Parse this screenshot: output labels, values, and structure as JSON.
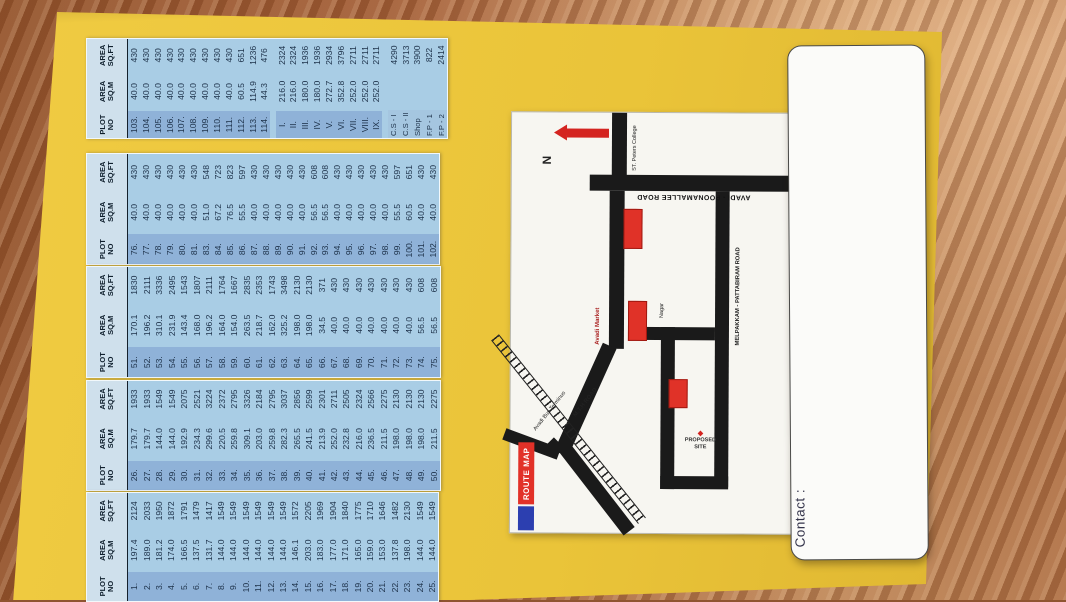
{
  "table_headers": [
    [
      "PLOT",
      "NO"
    ],
    [
      "AREA",
      "SQ.M"
    ],
    [
      "AREA",
      "SQ.FT"
    ]
  ],
  "tables": [
    {
      "name": "plots-103-114-and-blocks",
      "rows": [
        [
          "103.",
          "40.0",
          "430"
        ],
        [
          "104.",
          "40.0",
          "430"
        ],
        [
          "105.",
          "40.0",
          "430"
        ],
        [
          "106.",
          "40.0",
          "430"
        ],
        [
          "107.",
          "40.0",
          "430"
        ],
        [
          "108.",
          "40.0",
          "430"
        ],
        [
          "109.",
          "40.0",
          "430"
        ],
        [
          "110.",
          "40.0",
          "430"
        ],
        [
          "111.",
          "40.0",
          "430"
        ],
        [
          "112.",
          "60.5",
          "651"
        ],
        [
          "113.",
          "114.9",
          "1236"
        ],
        [
          "114.",
          "44.3",
          "476"
        ],
        null,
        [
          "I.",
          "216.0",
          "2324"
        ],
        [
          "II.",
          "216.0",
          "2324"
        ],
        [
          "III.",
          "180.0",
          "1936"
        ],
        [
          "IV.",
          "180.0",
          "1936"
        ],
        [
          "V.",
          "272.7",
          "2934"
        ],
        [
          "VI.",
          "352.8",
          "3796"
        ],
        [
          "VII.",
          "252.0",
          "2711"
        ],
        [
          "VIII.",
          "252.0",
          "2711"
        ],
        [
          "IX.",
          "252.0",
          "2711"
        ],
        null,
        [
          "C.S - I",
          "",
          "4290"
        ],
        [
          "C.S - II",
          "",
          "3713"
        ],
        [
          "Shop",
          "",
          "3900"
        ],
        [
          "F.P - 1",
          "",
          "822"
        ],
        [
          "F.P - 2",
          "",
          "2414"
        ]
      ]
    },
    {
      "name": "plots-76-102",
      "rows": [
        [
          "76.",
          "40.0",
          "430"
        ],
        [
          "77.",
          "40.0",
          "430"
        ],
        [
          "78.",
          "40.0",
          "430"
        ],
        [
          "79.",
          "40.0",
          "430"
        ],
        [
          "80.",
          "40.0",
          "430"
        ],
        [
          "81.",
          "40.0",
          "430"
        ],
        [
          "83.",
          "51.0",
          "548"
        ],
        [
          "84.",
          "67.2",
          "723"
        ],
        [
          "85.",
          "76.5",
          "823"
        ],
        [
          "86.",
          "55.5",
          "597"
        ],
        [
          "87.",
          "40.0",
          "430"
        ],
        [
          "88.",
          "40.0",
          "430"
        ],
        [
          "89.",
          "40.0",
          "430"
        ],
        [
          "90.",
          "40.0",
          "430"
        ],
        [
          "91.",
          "40.0",
          "430"
        ],
        [
          "92.",
          "56.5",
          "608"
        ],
        [
          "93.",
          "56.5",
          "608"
        ],
        [
          "94.",
          "40.0",
          "430"
        ],
        [
          "95.",
          "40.0",
          "430"
        ],
        [
          "96.",
          "40.0",
          "430"
        ],
        [
          "97.",
          "40.0",
          "430"
        ],
        [
          "98.",
          "40.0",
          "430"
        ],
        [
          "99.",
          "55.5",
          "597"
        ],
        [
          "100.",
          "60.5",
          "651"
        ],
        [
          "101.",
          "40.0",
          "430"
        ],
        [
          "102.",
          "40.0",
          "430"
        ]
      ]
    },
    {
      "name": "plots-51-75",
      "rows": [
        [
          "51.",
          "170.1",
          "1830"
        ],
        [
          "52.",
          "196.2",
          "2111"
        ],
        [
          "53.",
          "310.1",
          "3336"
        ],
        [
          "54.",
          "231.9",
          "2495"
        ],
        [
          "55.",
          "143.4",
          "1543"
        ],
        [
          "56.",
          "168.0",
          "1807"
        ],
        [
          "57.",
          "196.2",
          "2111"
        ],
        [
          "58.",
          "164.0",
          "1764"
        ],
        [
          "59.",
          "154.0",
          "1667"
        ],
        [
          "60.",
          "263.5",
          "2835"
        ],
        [
          "61.",
          "218.7",
          "2353"
        ],
        [
          "62.",
          "162.0",
          "1743"
        ],
        [
          "63.",
          "325.2",
          "3498"
        ],
        [
          "64.",
          "198.0",
          "2130"
        ],
        [
          "65.",
          "198.0",
          "2130"
        ],
        [
          "66.",
          "34.5",
          "371"
        ],
        [
          "67.",
          "40.0",
          "430"
        ],
        [
          "68.",
          "40.0",
          "430"
        ],
        [
          "69.",
          "40.0",
          "430"
        ],
        [
          "70.",
          "40.0",
          "430"
        ],
        [
          "71.",
          "40.0",
          "430"
        ],
        [
          "72.",
          "40.0",
          "430"
        ],
        [
          "73.",
          "40.0",
          "430"
        ],
        [
          "74.",
          "56.5",
          "608"
        ],
        [
          "75.",
          "56.5",
          "608"
        ]
      ]
    },
    {
      "name": "plots-26-50",
      "rows": [
        [
          "26.",
          "179.7",
          "1933"
        ],
        [
          "27.",
          "179.7",
          "1933"
        ],
        [
          "28.",
          "144.0",
          "1549"
        ],
        [
          "29.",
          "144.0",
          "1549"
        ],
        [
          "30.",
          "192.9",
          "2075"
        ],
        [
          "31.",
          "234.3",
          "2521"
        ],
        [
          "32.",
          "299.6",
          "3224"
        ],
        [
          "33.",
          "220.5",
          "2372"
        ],
        [
          "34.",
          "259.8",
          "2795"
        ],
        [
          "35.",
          "309.1",
          "3326"
        ],
        [
          "36.",
          "203.0",
          "2184"
        ],
        [
          "37.",
          "259.8",
          "2795"
        ],
        [
          "38.",
          "282.3",
          "3037"
        ],
        [
          "39.",
          "265.5",
          "2856"
        ],
        [
          "40.",
          "241.5",
          "2599"
        ],
        [
          "41.",
          "213.9",
          "2301"
        ],
        [
          "42.",
          "252.0",
          "2711"
        ],
        [
          "43.",
          "232.8",
          "2505"
        ],
        [
          "44.",
          "216.0",
          "2324"
        ],
        [
          "45.",
          "236.5",
          "2566"
        ],
        [
          "46.",
          "211.5",
          "2275"
        ],
        [
          "47.",
          "198.0",
          "2130"
        ],
        [
          "48.",
          "198.0",
          "2130"
        ],
        [
          "49.",
          "198.0",
          "2130"
        ],
        [
          "50.",
          "211.5",
          "2275"
        ]
      ]
    },
    {
      "name": "plots-1-25",
      "rows": [
        [
          "1.",
          "197.4",
          "2124"
        ],
        [
          "2.",
          "189.0",
          "2033"
        ],
        [
          "3.",
          "181.2",
          "1950"
        ],
        [
          "4.",
          "174.0",
          "1872"
        ],
        [
          "5.",
          "166.5",
          "1791"
        ],
        [
          "6.",
          "137.5",
          "1479"
        ],
        [
          "7.",
          "131.7",
          "1417"
        ],
        [
          "8.",
          "144.0",
          "1549"
        ],
        [
          "9.",
          "144.0",
          "1549"
        ],
        [
          "10.",
          "144.0",
          "1549"
        ],
        [
          "11.",
          "144.0",
          "1549"
        ],
        [
          "12.",
          "144.0",
          "1549"
        ],
        [
          "13.",
          "144.0",
          "1549"
        ],
        [
          "14.",
          "146.1",
          "1572"
        ],
        [
          "15.",
          "203.0",
          "2205"
        ],
        [
          "16.",
          "183.0",
          "1969"
        ],
        [
          "17.",
          "177.0",
          "1904"
        ],
        [
          "18.",
          "171.0",
          "1840"
        ],
        [
          "19.",
          "165.0",
          "1775"
        ],
        [
          "20.",
          "159.0",
          "1710"
        ],
        [
          "21.",
          "153.0",
          "1646"
        ],
        [
          "22.",
          "137.8",
          "1482"
        ],
        [
          "23.",
          "198.0",
          "2130"
        ],
        [
          "24.",
          "144.0",
          "1549"
        ],
        [
          "25.",
          "144.0",
          "1549"
        ]
      ]
    }
  ],
  "map": {
    "title": "ROUTE MAP",
    "north": "N",
    "labels": {
      "road_top": "AVADI - POONAMALLEE ROAD",
      "road_right": "MELPAKKAM - PATTABIRAM ROAD",
      "mth_road": "M.T.H ROAD",
      "st_peters": "ST. Peters College",
      "avadi_market": "Avadi Market",
      "bus_terminus": "Avadi Bus Terminus",
      "nagar": "Nagar",
      "proposed_site_line1": "PROPOSED",
      "proposed_site_line2": "SITE"
    }
  },
  "card": {
    "contact_label": "Contact :"
  }
}
